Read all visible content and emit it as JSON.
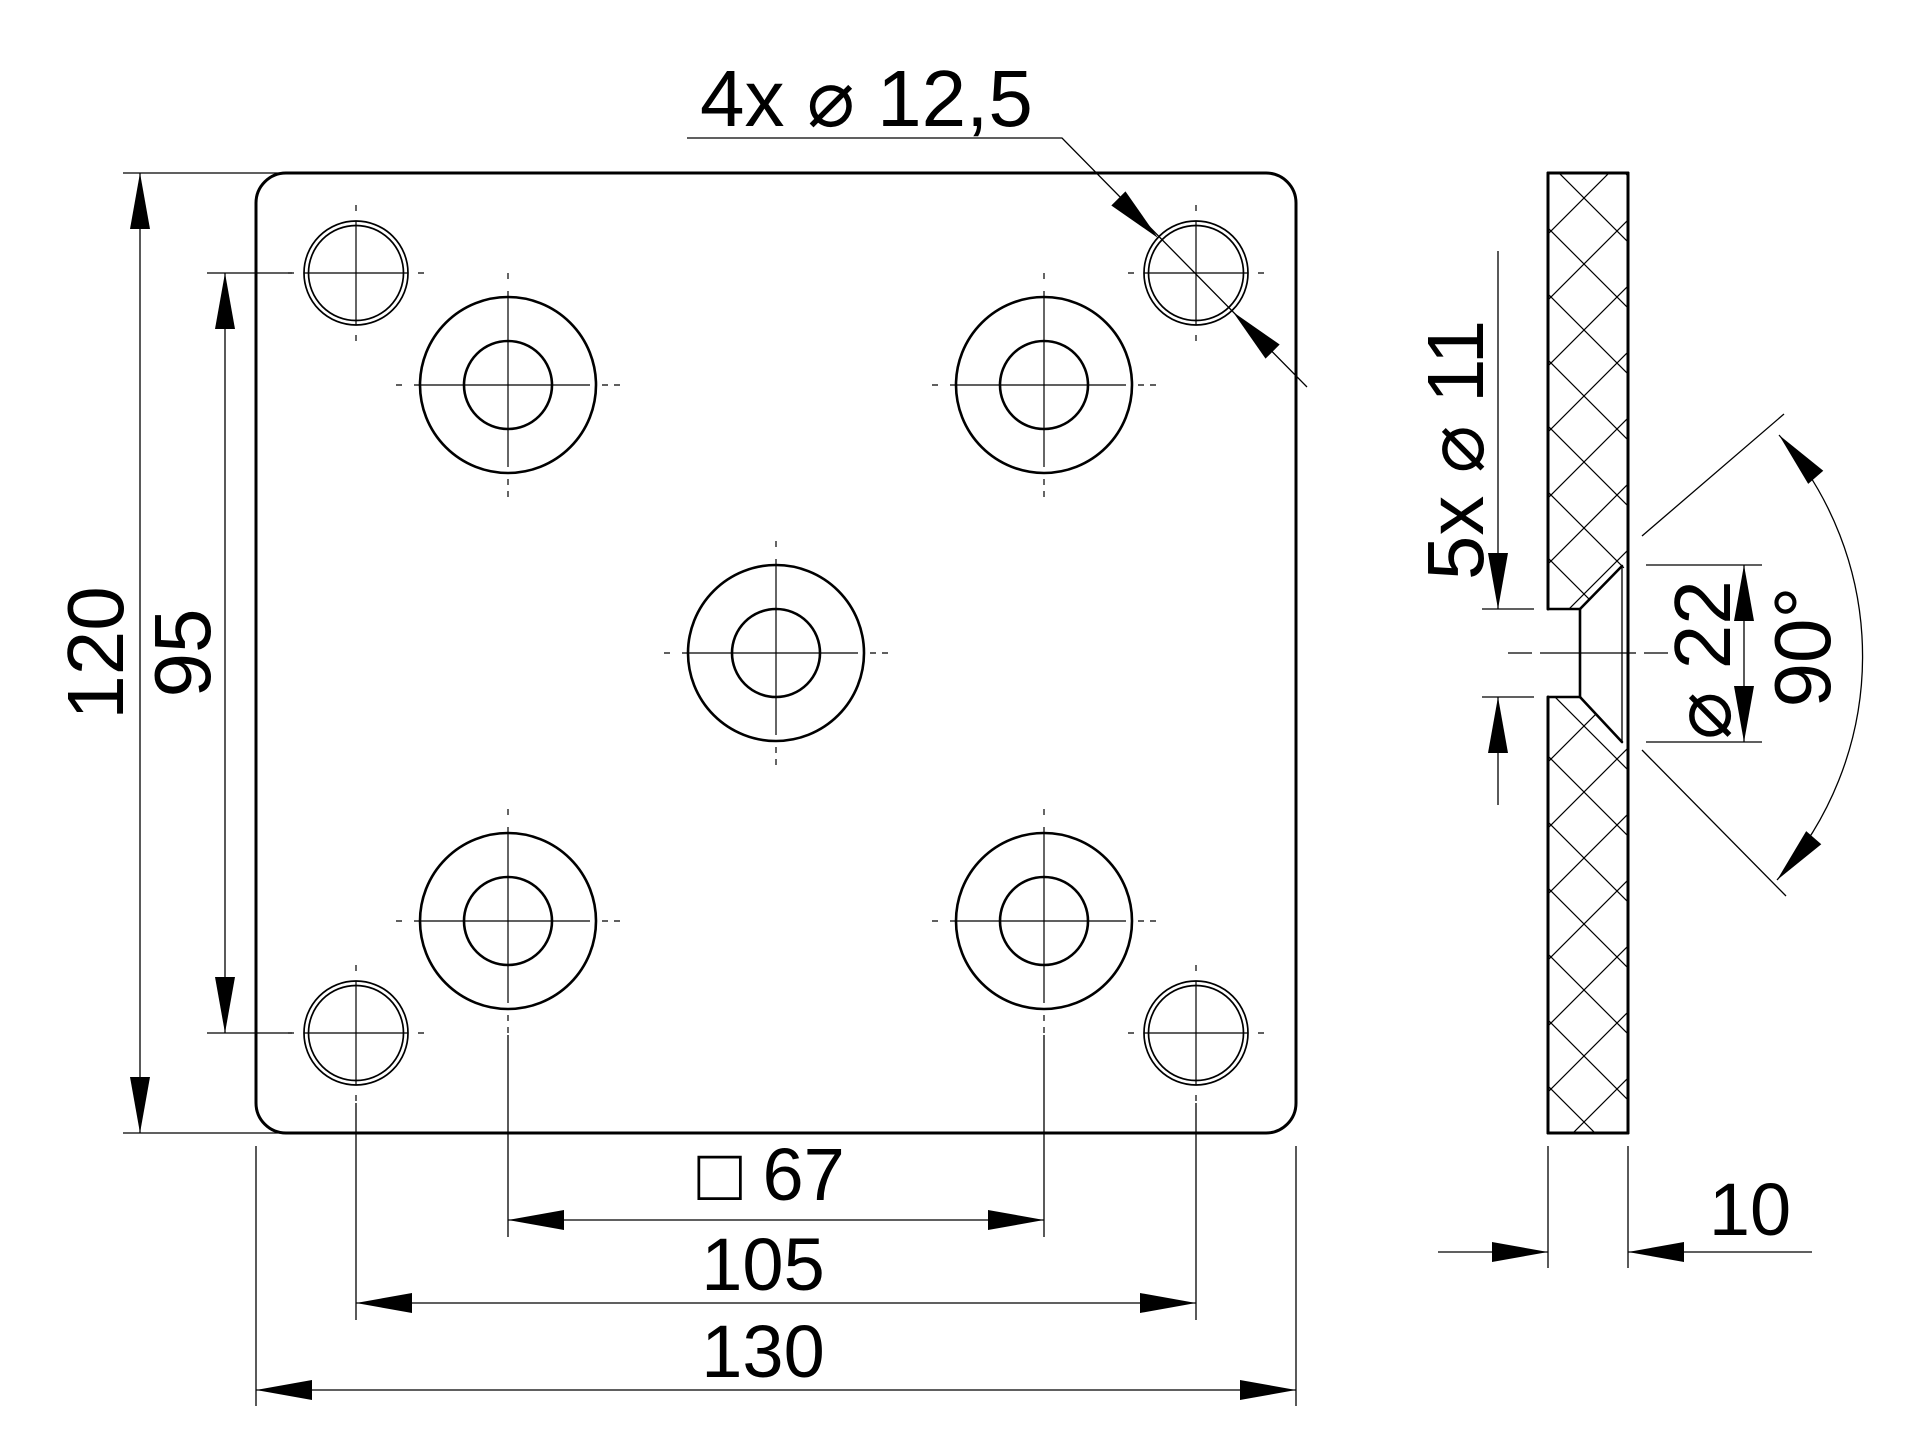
{
  "drawing": {
    "type": "2D technical drawing, countersunk mounting plate",
    "units": "mm",
    "colors": {
      "line": "#000000",
      "background": "#ffffff"
    },
    "plate": {
      "width_mm": 130,
      "height_mm": 120,
      "thickness_mm": 10,
      "corner_hole_spacing_mm": 105,
      "hole_row_spacing_mm": 95,
      "countersunk_square_spacing_mm": 67
    }
  },
  "front_view": {
    "callout": {
      "label": "4x ⌀ 12,5",
      "count": 4,
      "diameter_mm": 12.5
    },
    "dims": {
      "height": {
        "label": "120",
        "value": 120
      },
      "hole_rows": {
        "label": "95",
        "value": 95
      },
      "csk_cols": {
        "label": "□ 67",
        "value": 67,
        "square_symbol": true
      },
      "corner_cols": {
        "label": "105",
        "value": 105
      },
      "width": {
        "label": "130",
        "value": 130
      }
    }
  },
  "side_view": {
    "dims": {
      "holes": {
        "label": "5x ⌀ 11",
        "count": 5,
        "diameter_mm": 11
      },
      "csk_dia": {
        "label": "⌀ 22",
        "value": 22
      },
      "angle": {
        "label": "90°",
        "value": 90
      },
      "thickness": {
        "label": "10",
        "value": 10
      }
    }
  }
}
